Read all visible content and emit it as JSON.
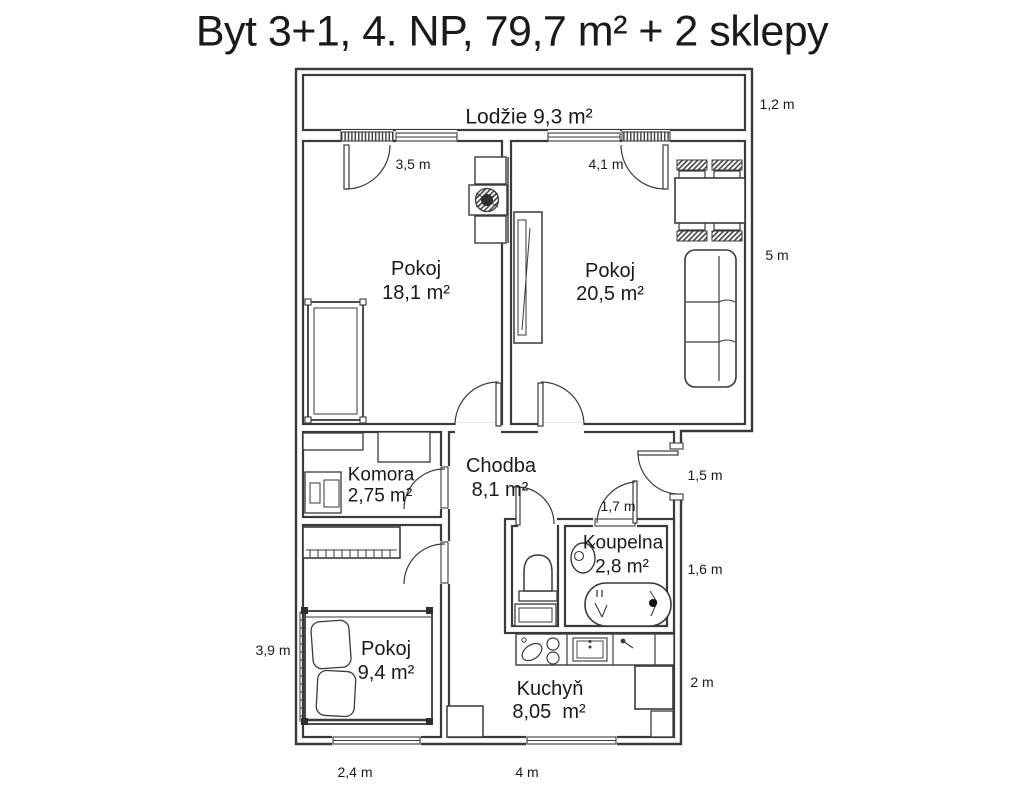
{
  "title": "Byt 3+1, 4. NP, 79,7 m² + 2 sklepy",
  "colors": {
    "walls": "#3a3a3a",
    "text": "#1a1a1a",
    "background": "#ffffff"
  },
  "rooms": {
    "lodzie": {
      "label": "Lodžie 9,3 m²"
    },
    "pokoj_18": {
      "name": "Pokoj",
      "area": "18,1 m²"
    },
    "pokoj_20": {
      "name": "Pokoj",
      "area": "20,5 m²"
    },
    "komora": {
      "name": "Komora",
      "area": "2,75 m²"
    },
    "chodba": {
      "name": "Chodba",
      "area": "8,1 m²"
    },
    "koupelna": {
      "name": "Koupelna",
      "area": "2,8 m²"
    },
    "pokoj_9": {
      "name": "Pokoj",
      "area": "9,4 m²"
    },
    "kuchyn": {
      "name": "Kuchyň",
      "area": "8,05  m²"
    }
  },
  "dimensions": {
    "lodzie_depth": "1,2 m",
    "pokoj_18_width": "3,5 m",
    "pokoj_20_width": "4,1 m",
    "pokoj_20_height": "5 m",
    "entry_wall": "1,5 m",
    "koupelna_door_wall": "1,7 m",
    "koupelna_height": "1,6 m",
    "kuchyn_right_height": "2 m",
    "pokoj_9_height": "3,9 m",
    "pokoj_9_width": "2,4 m",
    "kuchyn_width": "4 m"
  }
}
